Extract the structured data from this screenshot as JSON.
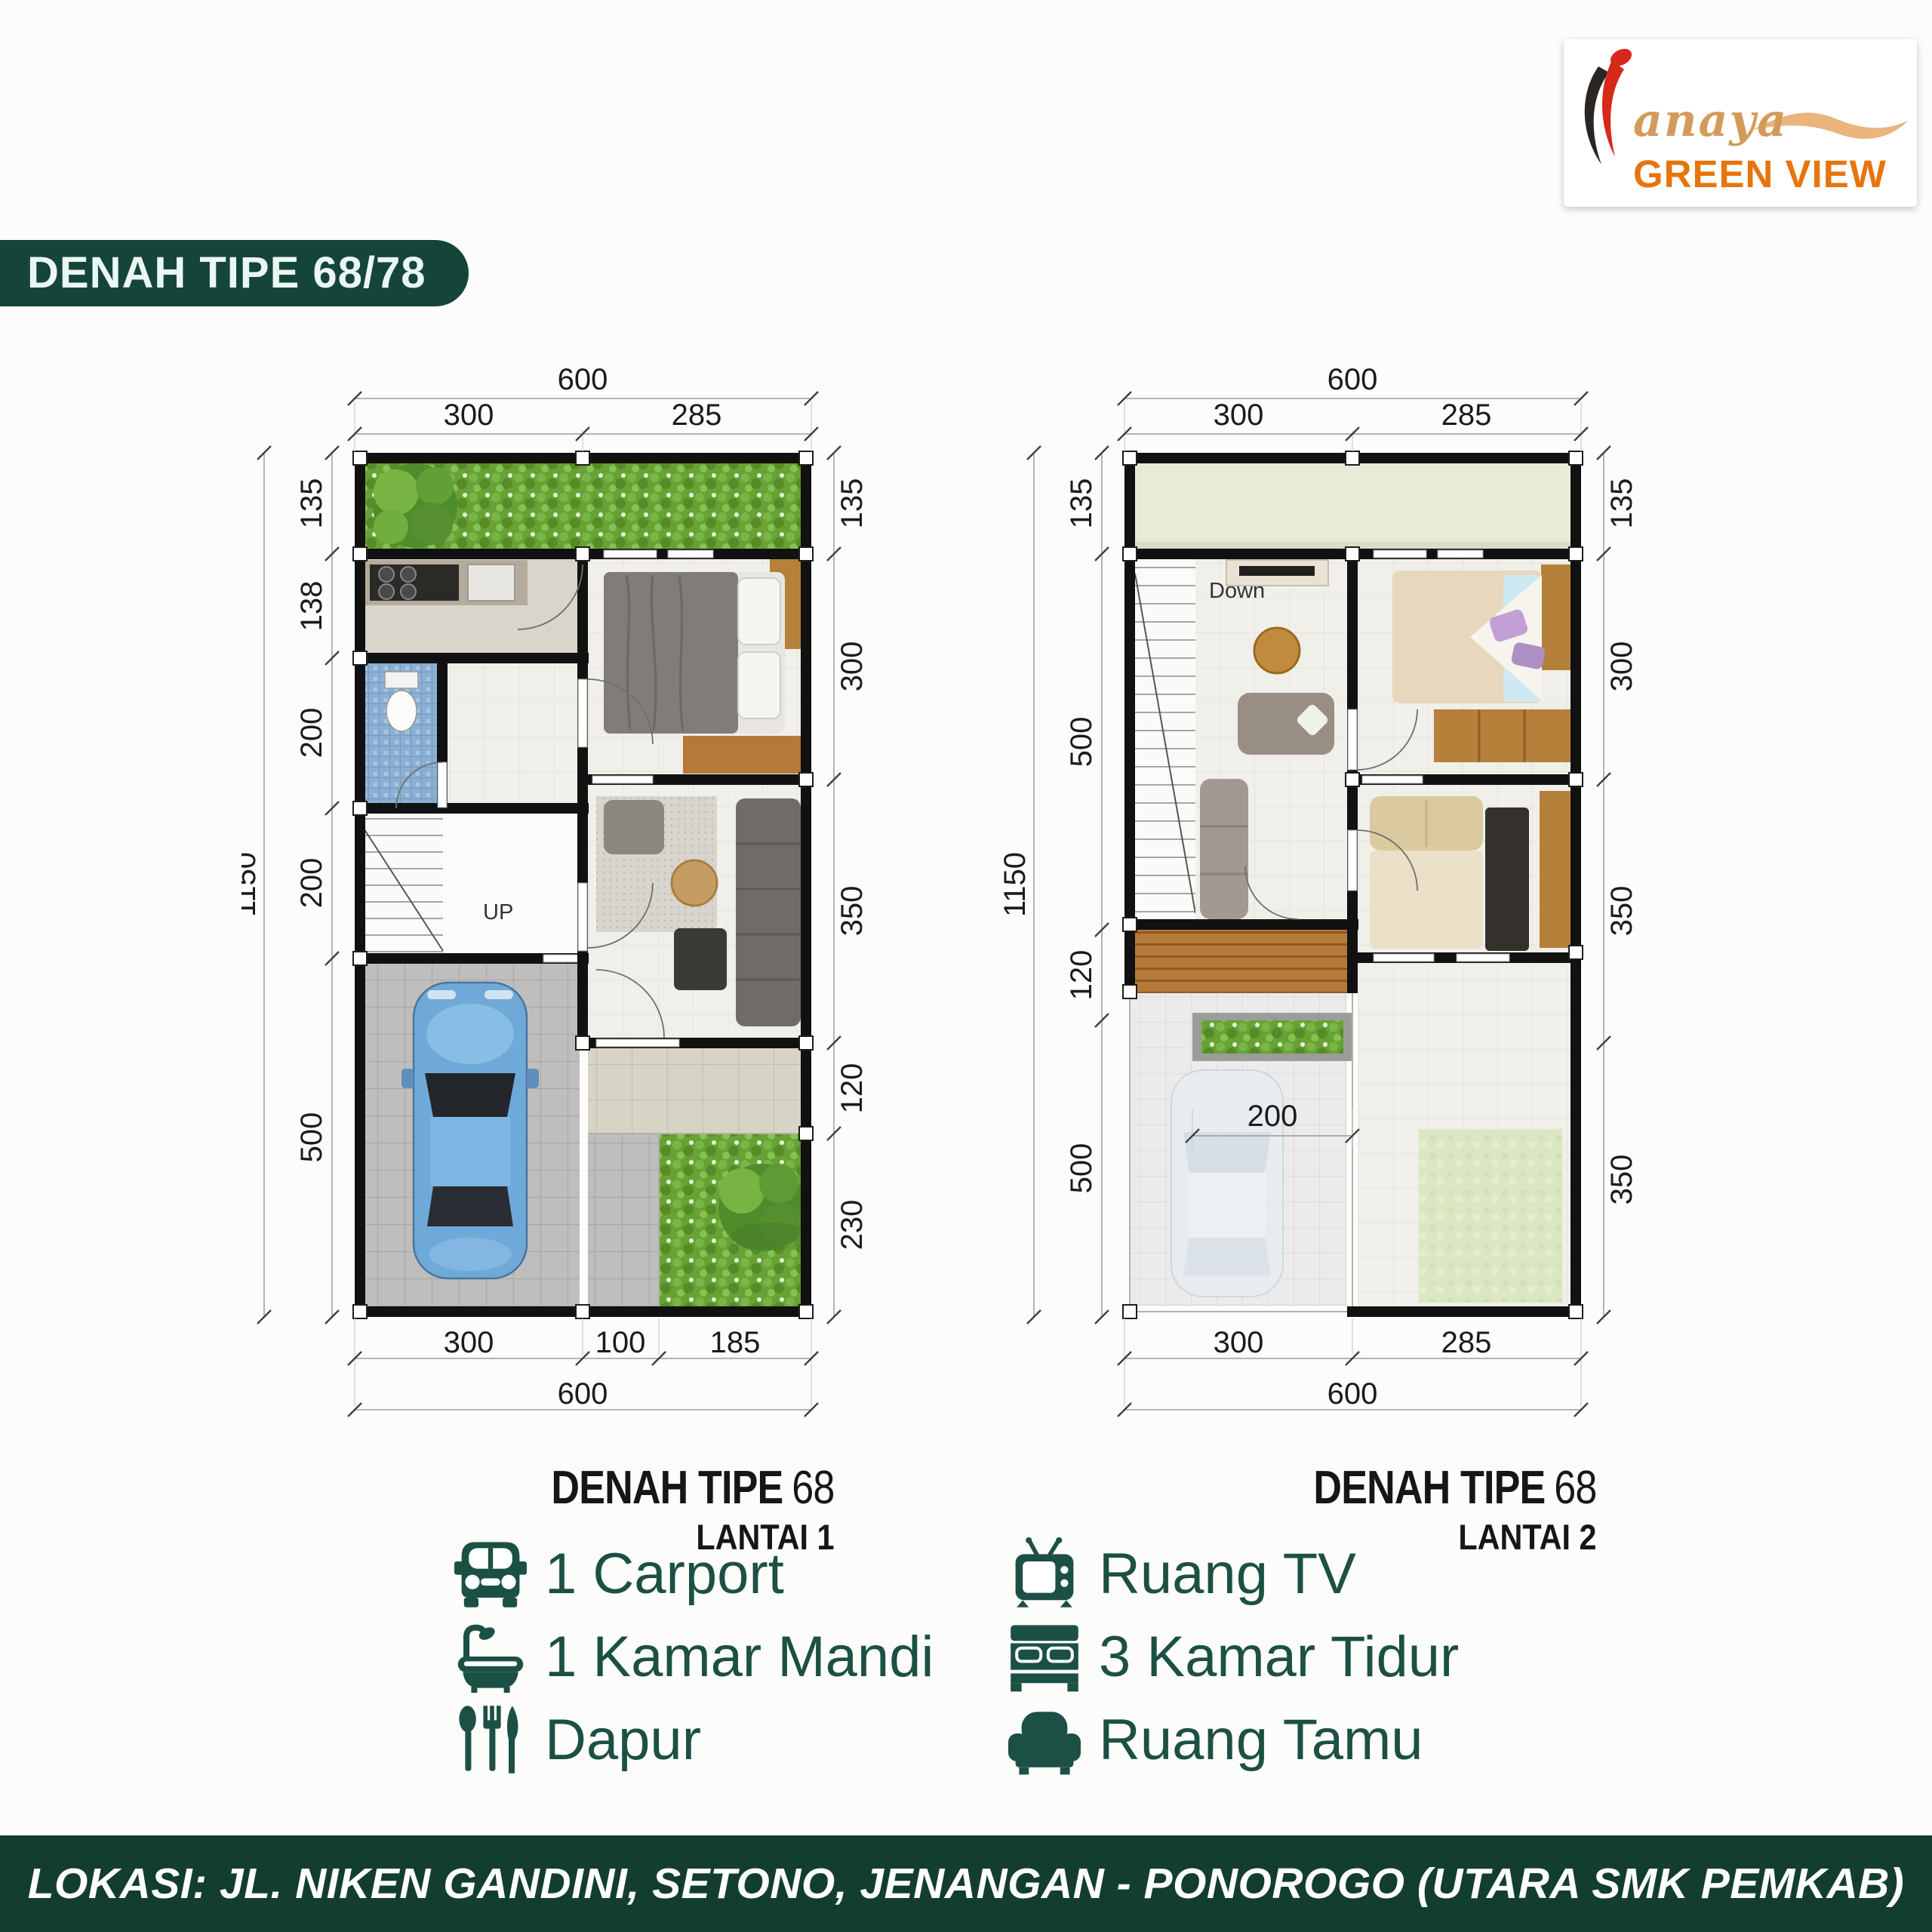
{
  "logo": {
    "script": "anaya",
    "caps": "GREEN VIEW",
    "orange": "#E6750D",
    "tan": "#D39B5B",
    "flame_red": "#D6281B",
    "flame_black": "#2A2624"
  },
  "badge": {
    "label": "DENAH TIPE 68/78",
    "bg": "#15453A"
  },
  "floor1": {
    "caption_title": "DENAH TIPE",
    "caption_number": "68",
    "caption_floor": "LANTAI 1",
    "stairs_label": "UP",
    "dim_top_total": "600",
    "dim_top_segments": [
      "300",
      "285"
    ],
    "dim_left_total": "1150",
    "dim_left_segments": [
      "135",
      "138",
      "200",
      "200",
      "500"
    ],
    "dim_right_segments": [
      "135",
      "300",
      "350",
      "120",
      "230"
    ],
    "dim_bottom_segments": [
      "300",
      "100",
      "185"
    ],
    "dim_bottom_total": "600"
  },
  "floor2": {
    "caption_title": "DENAH TIPE",
    "caption_number": "68",
    "caption_floor": "LANTAI 2",
    "stairs_label": "Down",
    "dim_inner": "200",
    "dim_top_total": "600",
    "dim_top_segments": [
      "300",
      "285"
    ],
    "dim_left_total": "1150",
    "dim_left_segments": [
      "135",
      "500",
      "120",
      "500"
    ],
    "dim_right_segments": [
      "135",
      "300",
      "350",
      "350"
    ],
    "dim_bottom_segments": [
      "300",
      "285"
    ],
    "dim_bottom_total": "600"
  },
  "legend": {
    "color": "#1C5044",
    "left": [
      {
        "icon": "car-icon",
        "label": "1 Carport"
      },
      {
        "icon": "bathtub-icon",
        "label": "1 Kamar Mandi"
      },
      {
        "icon": "cutlery-icon",
        "label": "Dapur"
      }
    ],
    "right": [
      {
        "icon": "tv-icon",
        "label": "Ruang TV"
      },
      {
        "icon": "bed-icon",
        "label": "3 Kamar Tidur"
      },
      {
        "icon": "sofa-icon",
        "label": "Ruang Tamu"
      }
    ]
  },
  "footer": {
    "text": "LOKASI: JL. NIKEN GANDINI, SETONO, JENANGAN - PONOROGO (UTARA SMK PEMKAB)",
    "bg": "#133D31"
  }
}
